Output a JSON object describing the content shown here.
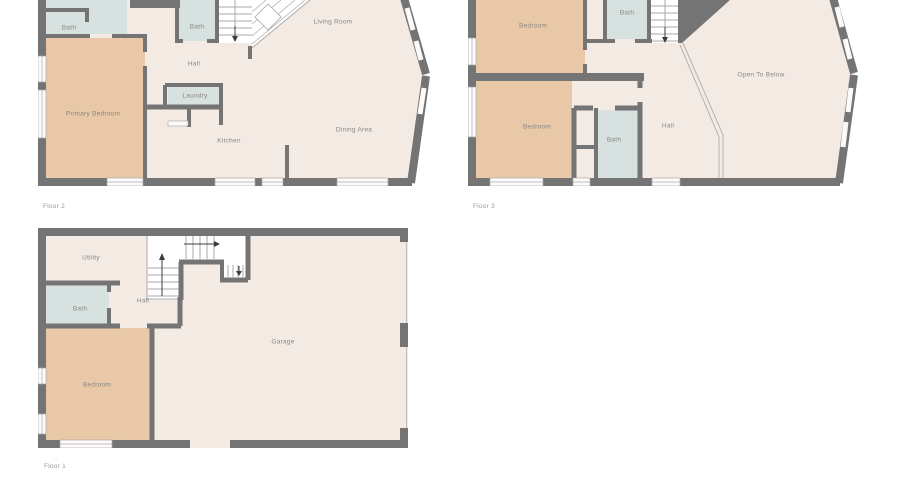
{
  "colors": {
    "wall": "#747474",
    "floor": "#f4eae4",
    "bedroom": "#e9c8a7",
    "bath": "#d7e1e0",
    "window": "#fdfbfa",
    "line": "#a8a8a8",
    "label": "#8a8681",
    "caption": "#9a9a9a",
    "background": "#ffffff"
  },
  "floors": [
    {
      "name": "Floor 2",
      "rooms": [
        {
          "label": "Bath"
        },
        {
          "label": "Bath"
        },
        {
          "label": "Living Room"
        },
        {
          "label": "Hall"
        },
        {
          "label": "Laundry"
        },
        {
          "label": "Primary Bedroom"
        },
        {
          "label": "Kitchen"
        },
        {
          "label": "Dining Area"
        }
      ]
    },
    {
      "name": "Floor 3",
      "rooms": [
        {
          "label": "Bedroom"
        },
        {
          "label": "Bath"
        },
        {
          "label": "Bedroom"
        },
        {
          "label": "Bath"
        },
        {
          "label": "Hall"
        },
        {
          "label": "Open To Below"
        }
      ]
    },
    {
      "name": "Floor 1",
      "rooms": [
        {
          "label": "Utility"
        },
        {
          "label": "Bath"
        },
        {
          "label": "Hall"
        },
        {
          "label": "Bedroom"
        },
        {
          "label": "Garage"
        }
      ]
    }
  ]
}
